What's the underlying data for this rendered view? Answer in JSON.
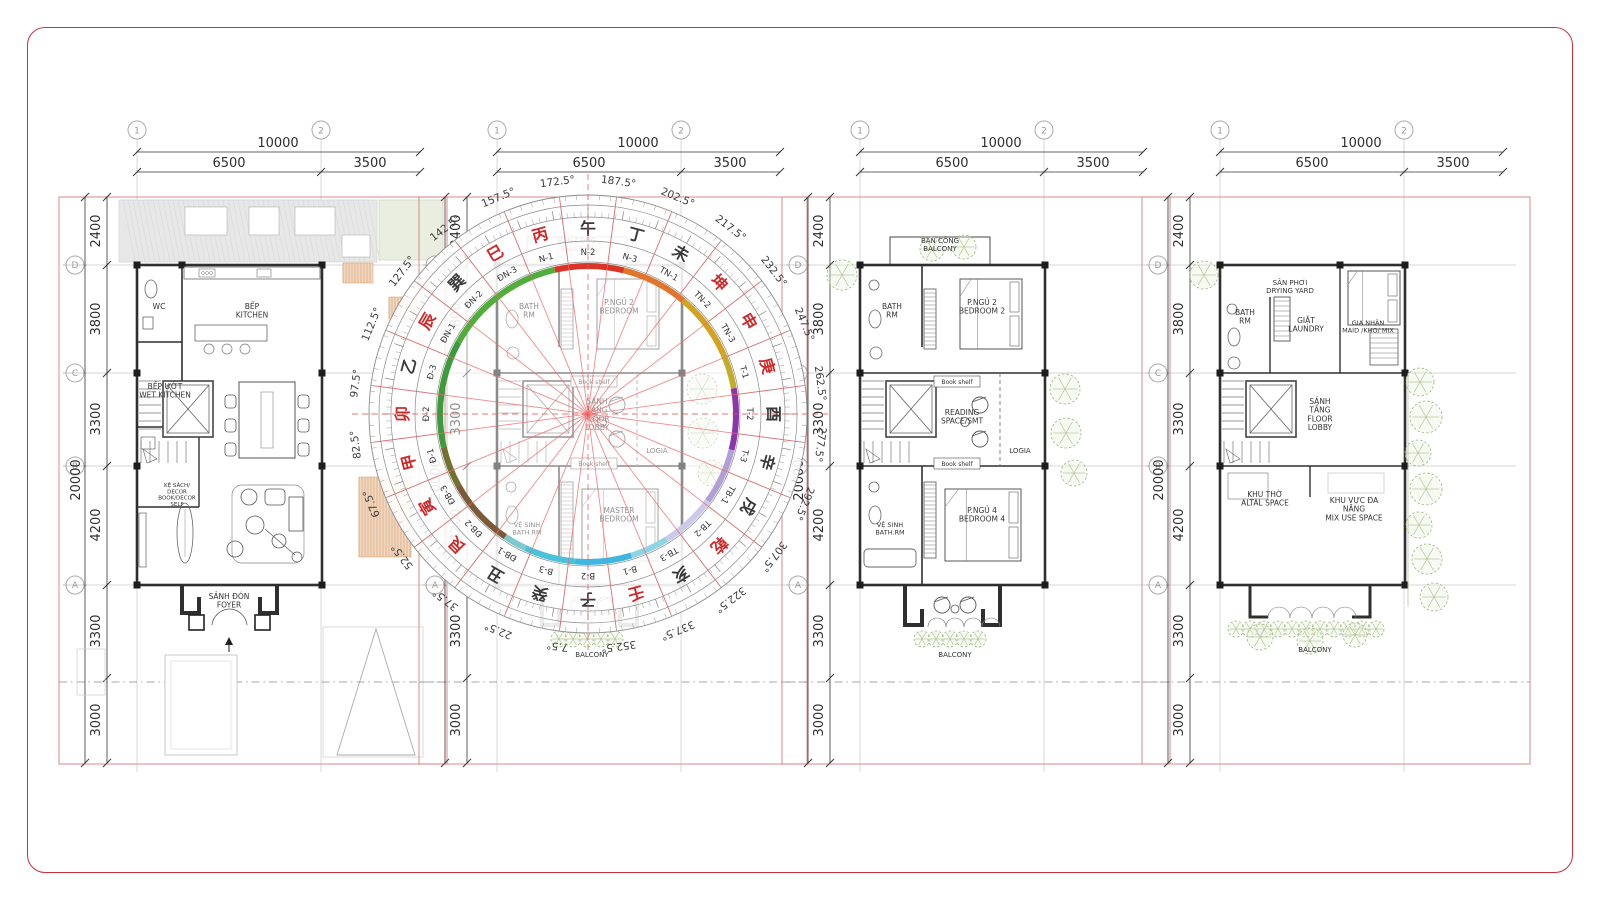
{
  "sheet": {
    "border_color": "#cf2e3e",
    "lot_line_color": "#d87e7e",
    "compass_line_color": "#ef6a6a"
  },
  "shared_dims": {
    "top_total": "10000",
    "top_segments": [
      "6500",
      "3500"
    ],
    "left_segments": [
      "2400",
      "3800",
      "3300",
      "4200",
      "3300",
      "3000"
    ],
    "left_total": "20000",
    "grid_cols": [
      "1",
      "2"
    ],
    "grid_rows": [
      "D",
      "C",
      "B",
      "A"
    ]
  },
  "plans": [
    {
      "name": "ground-floor-plan",
      "kind": "ground",
      "labels": [
        {
          "t": "WC",
          "x": 22,
          "y": 112
        },
        {
          "t": "BẾP\nKITCHEN",
          "x": 115,
          "y": 112
        },
        {
          "t": "BẾP ƯỚT\nWET KITCHEN",
          "x": 28,
          "y": 192
        },
        {
          "t": "KỆ SÁCH/\nDECOR\nBOOK/DECOR\nSELF",
          "x": 40,
          "y": 290,
          "fs": 5.5
        },
        {
          "t": "SẢNH ĐÓN\nFOYER",
          "x": 92,
          "y": 402
        }
      ]
    },
    {
      "name": "bedroom-floor-plan-compass",
      "kind": "upper",
      "labels": [
        {
          "t": "BAN CÔNG\nBALCONY",
          "x": 80,
          "y": 46,
          "fs": 7
        },
        {
          "t": "BATH\nRM",
          "x": 32,
          "y": 112
        },
        {
          "t": "P.NGỦ 2\nBEDROOM",
          "x": 122,
          "y": 108
        },
        {
          "t": "Book shelf",
          "x": 97,
          "y": 187,
          "box": true
        },
        {
          "t": "SẢNH\nTẦNG\nFLOOR\nLOBBY",
          "x": 100,
          "y": 207,
          "fs": 7.5
        },
        {
          "t": "LOGIA",
          "x": 160,
          "y": 256,
          "fs": 7
        },
        {
          "t": "Book shelf",
          "x": 97,
          "y": 269,
          "box": true
        },
        {
          "t": "VỆ SINH\nBATH.RM",
          "x": 30,
          "y": 330,
          "fs": 6.5
        },
        {
          "t": "MASTER\nBEDROOM",
          "x": 122,
          "y": 316
        },
        {
          "t": "BALCONY",
          "x": 95,
          "y": 460,
          "fs": 7
        }
      ]
    },
    {
      "name": "bedroom-floor-plan-2",
      "kind": "upper2",
      "labels": [
        {
          "t": "BAN CÔNG\nBALCONY",
          "x": 80,
          "y": 46,
          "fs": 7
        },
        {
          "t": "BATH\nRM",
          "x": 32,
          "y": 112
        },
        {
          "t": "P.NGỦ 2\nBEDROOM 2",
          "x": 122,
          "y": 108
        },
        {
          "t": "Book shelf",
          "x": 97,
          "y": 187,
          "box": true
        },
        {
          "t": "READING\nSPACE/SMT",
          "x": 102,
          "y": 218
        },
        {
          "t": "LOGIA",
          "x": 160,
          "y": 256,
          "fs": 7
        },
        {
          "t": "Book shelf",
          "x": 97,
          "y": 269,
          "box": true
        },
        {
          "t": "VỆ SINH\nBATH.RM",
          "x": 30,
          "y": 330,
          "fs": 6.5
        },
        {
          "t": "P.NGỦ 4\nBEDROOM 4",
          "x": 122,
          "y": 316
        },
        {
          "t": "BALCONY",
          "x": 95,
          "y": 460,
          "fs": 7
        }
      ]
    },
    {
      "name": "top-floor-plan",
      "kind": "top",
      "labels": [
        {
          "t": "SÂN PHƠI\nDRYING YARD",
          "x": 70,
          "y": 88,
          "fs": 7
        },
        {
          "t": "BATH\nRM",
          "x": 25,
          "y": 118
        },
        {
          "t": "GIẶT\nLAUNDRY",
          "x": 86,
          "y": 126
        },
        {
          "t": "GIA NHÂN\nMAID /KHO/ MIX",
          "x": 148,
          "y": 128,
          "fs": 6.5
        },
        {
          "t": "SẢNH\nTẦNG\nFLOOR\nLOBBY",
          "x": 100,
          "y": 207,
          "fs": 7.5
        },
        {
          "t": "KHU THỜ\nALTAL SPACE",
          "x": 45,
          "y": 300
        },
        {
          "t": "KHU VỰC ĐA\nNĂNG\nMIX USE SPACE",
          "x": 134,
          "y": 306
        },
        {
          "t": "BALCONY",
          "x": 95,
          "y": 455,
          "fs": 7
        }
      ]
    }
  ],
  "compass": {
    "degree_labels": [
      "7.5°",
      "22.5°",
      "37.5°",
      "52.5°",
      "67.5°",
      "82.5°",
      "97.5°",
      "112.5°",
      "127.5°",
      "142.5°",
      "157.5°",
      "172.5°",
      "187.5°",
      "202.5°",
      "217.5°",
      "232.5°",
      "247.5°",
      "262.5°",
      "277.5°",
      "292.5°",
      "307.5°",
      "322.5°",
      "337.5°",
      "352.5°"
    ],
    "sectors": [
      "N-2",
      "N-3",
      "TN-1",
      "TN-2",
      "TN-3",
      "T-1",
      "T-2",
      "T-3",
      "TB-1",
      "TB-2",
      "TB-3",
      "B-1",
      "B-2",
      "B-3",
      "ĐB-1",
      "ĐB-2",
      "ĐB-3",
      "Đ-1",
      "Đ-2",
      "Đ-3",
      "ĐN-1",
      "ĐN-2",
      "ĐN-3",
      "N-1"
    ],
    "mountains": [
      {
        "c": "午"
      },
      {
        "c": "丁"
      },
      {
        "c": "未"
      },
      {
        "c": "坤",
        "red": 1
      },
      {
        "c": "申",
        "red": 1
      },
      {
        "c": "庚",
        "red": 1
      },
      {
        "c": "酉"
      },
      {
        "c": "辛"
      },
      {
        "c": "戌"
      },
      {
        "c": "乾",
        "red": 1
      },
      {
        "c": "亥"
      },
      {
        "c": "壬",
        "red": 1
      },
      {
        "c": "子"
      },
      {
        "c": "癸"
      },
      {
        "c": "丑"
      },
      {
        "c": "艮",
        "red": 1
      },
      {
        "c": "寅",
        "red": 1
      },
      {
        "c": "甲",
        "red": 1
      },
      {
        "c": "卯",
        "red": 1
      },
      {
        "c": "乙"
      },
      {
        "c": "辰",
        "red": 1
      },
      {
        "c": "巽"
      },
      {
        "c": "巳",
        "red": 1
      },
      {
        "c": "丙",
        "red": 1
      }
    ],
    "arc_segments": [
      {
        "a": 347,
        "b": 14,
        "c": "#d93427"
      },
      {
        "a": 14,
        "b": 40,
        "c": "#e0762b"
      },
      {
        "a": 40,
        "b": 66,
        "c": "#d4a122"
      },
      {
        "a": 66,
        "b": 80,
        "c": "#c4ad2c"
      },
      {
        "a": 80,
        "b": 104,
        "c": "#8e35a8"
      },
      {
        "a": 104,
        "b": 126,
        "c": "#b29fd6"
      },
      {
        "a": 126,
        "b": 148,
        "c": "#cdc9ea"
      },
      {
        "a": 148,
        "b": 163,
        "c": "#8fd4e4"
      },
      {
        "a": 163,
        "b": 185,
        "c": "#3fb6e0"
      },
      {
        "a": 185,
        "b": 205,
        "c": "#49c2da"
      },
      {
        "a": 205,
        "b": 214,
        "c": "#7ec8cf"
      },
      {
        "a": 214,
        "b": 241,
        "c": "#7c5a38"
      },
      {
        "a": 241,
        "b": 257,
        "c": "#74702e"
      },
      {
        "a": 257,
        "b": 299,
        "c": "#3e9b3b"
      },
      {
        "a": 299,
        "b": 347,
        "c": "#52ad3c"
      }
    ]
  }
}
